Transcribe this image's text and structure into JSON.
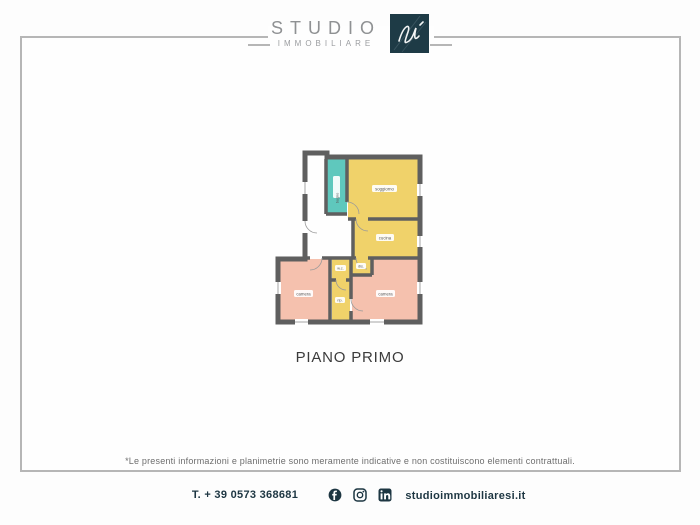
{
  "logo": {
    "studio": "STUDIO",
    "immobiliare": "IMMOBILIARE",
    "monogram": "si-signature",
    "square_color": "#1e3b46"
  },
  "floorplan": {
    "title": "PIANO PRIMO",
    "rooms": [
      {
        "label": "soggiorno",
        "color": "#f0d26a"
      },
      {
        "label": "bagno",
        "color": "#5fc8bd"
      },
      {
        "label": "cucina",
        "color": "#f0d26a"
      },
      {
        "label": "camera",
        "color": "#f5c1ae"
      },
      {
        "label": "camera",
        "color": "#f5c1ae"
      },
      {
        "label": "w.c.",
        "color": "#f0d26a"
      },
      {
        "label": "dis.",
        "color": "#f0d26a"
      },
      {
        "label": "rip.",
        "color": "#f0d26a"
      }
    ],
    "wall_color": "#5f5f5f"
  },
  "disclaimer": "*Le presenti informazioni e planimetrie sono meramente indicative e non costituiscono elementi contrattuali.",
  "footer": {
    "phone": "T. + 39 0573 368681",
    "website": "studioimmobiliaresi.it",
    "social": [
      "facebook",
      "instagram",
      "linkedin"
    ],
    "text_color": "#1d3642"
  },
  "frame_color": "#b6b6b6"
}
